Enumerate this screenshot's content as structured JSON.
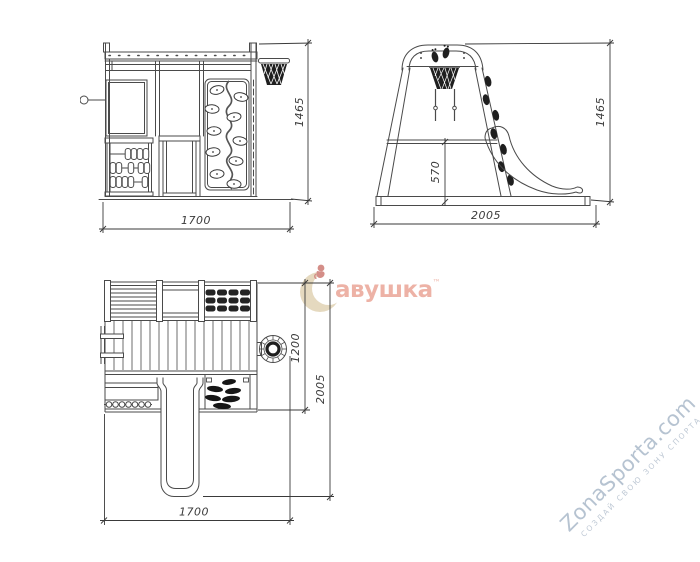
{
  "page": {
    "background": "#ffffff"
  },
  "drawing": {
    "line_color": "#4a4a4a",
    "dark_fill": "#1f1f1f",
    "dim_color": "#3a3a3a"
  },
  "views": {
    "front": {
      "dims": {
        "width": "1700",
        "height": "1465"
      }
    },
    "side": {
      "dims": {
        "width": "2005",
        "height": "1465",
        "platform_height": "570"
      }
    },
    "plan": {
      "dims": {
        "width": "1700",
        "ring_offset": "1200",
        "depth": "2005"
      }
    }
  },
  "watermarks": {
    "center": {
      "brand": "авушка",
      "tm": "™",
      "text_color": "#e9a091",
      "crescent_color": "#d9c7a2",
      "figure_color": "#c05a50"
    },
    "corner": {
      "site": "ZonaSporta.com",
      "slogan": "СОЗДАЙ СВОЮ ЗОНУ СПОРТА",
      "site_color": "#b3c0cf",
      "slogan_color": "#bfc9d5"
    }
  }
}
